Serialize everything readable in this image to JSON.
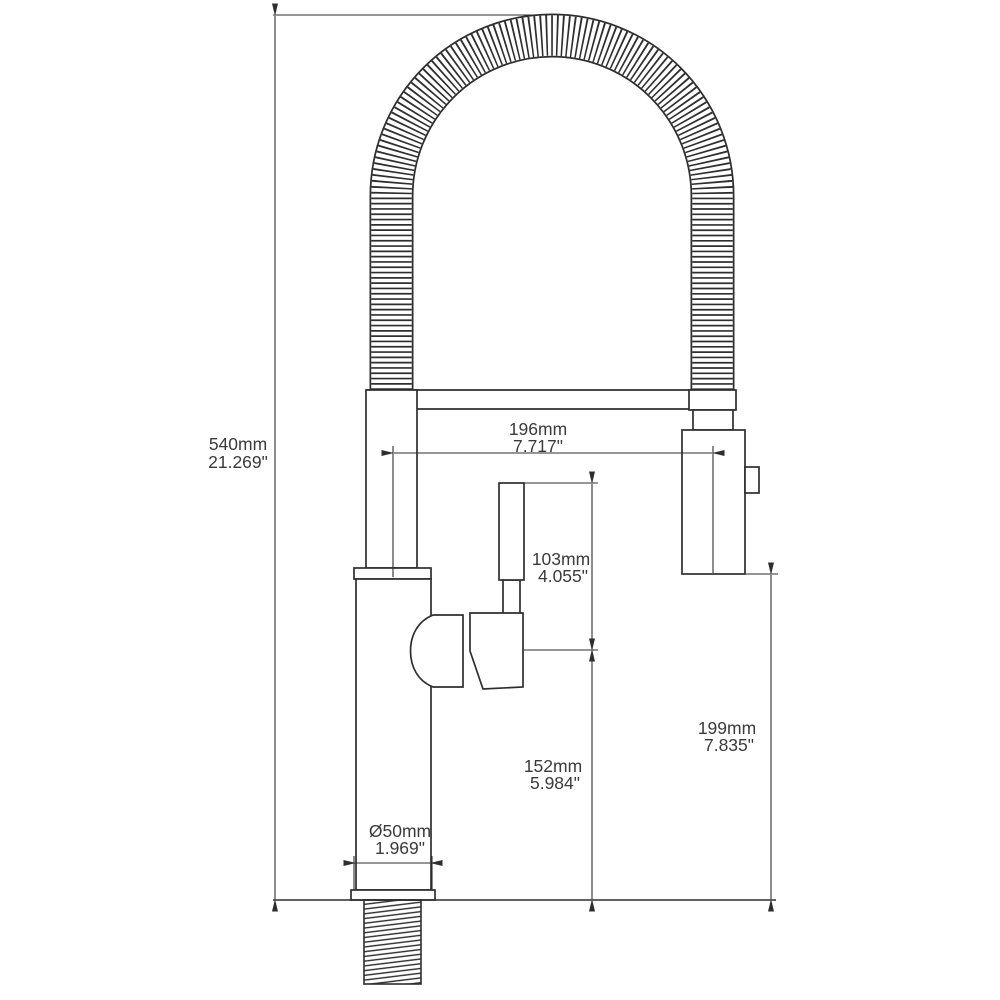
{
  "drawing": {
    "title": "faucet-dimension-drawing",
    "subject": "pull-down spring kitchen faucet, front elevation with dimensions",
    "line_color": "#2e2e2e",
    "text_color": "#3a3a3a",
    "background_color": "#ffffff",
    "dimensions": [
      {
        "id": "overall-height",
        "mm": "540mm",
        "inch": "21.269\""
      },
      {
        "id": "spout-reach",
        "mm": "196mm",
        "inch": "7.717\""
      },
      {
        "id": "handle-height",
        "mm": "103mm",
        "inch": "4.055\""
      },
      {
        "id": "handle-to-deck",
        "mm": "152mm",
        "inch": "5.984\""
      },
      {
        "id": "sprayhead-to-deck",
        "mm": "199mm",
        "inch": "7.835\""
      },
      {
        "id": "base-diameter",
        "mm": "Ø50mm",
        "inch": "1.969\""
      }
    ]
  }
}
